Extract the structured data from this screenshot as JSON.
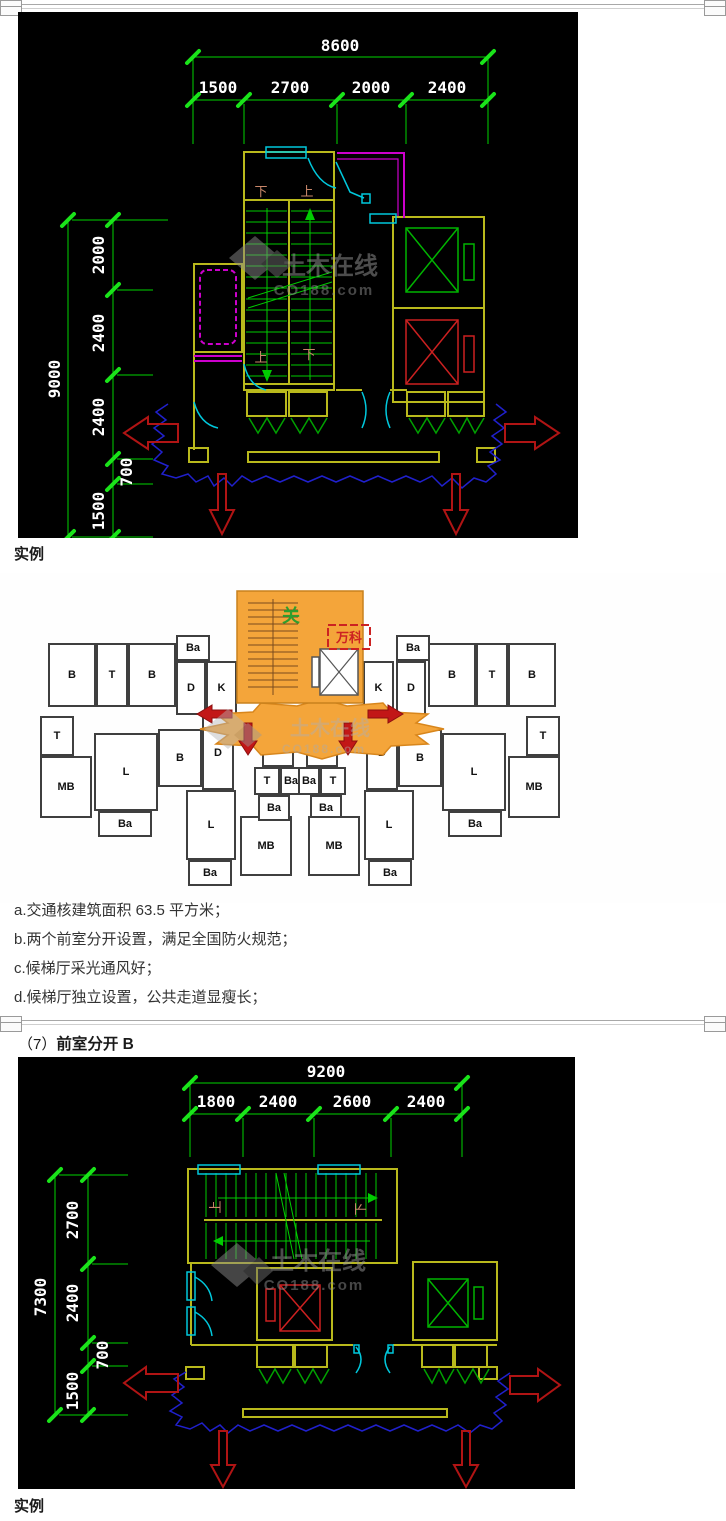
{
  "page": {
    "captions": [
      "实例",
      "实例"
    ],
    "notes": [
      "a.交通核建筑面积 63.5 平方米；",
      "b.两个前室分开设置，满足全国防火规范；",
      "c.候梯厅采光通风好；",
      "d.候梯厅独立设置，公共走道显瘦长；"
    ],
    "section_heading": {
      "index": "（7）",
      "title": "前室分开 B"
    }
  },
  "watermark": {
    "brand": "土木在线",
    "site": "CO188.com"
  },
  "cad1": {
    "top_dims": {
      "total": "8600",
      "segments": [
        "1500",
        "2700",
        "2000",
        "2400"
      ]
    },
    "left_dims": {
      "total": "9000",
      "segments": [
        "2000",
        "2400",
        "2400",
        "700",
        "1500"
      ]
    },
    "stair_labels": {
      "top_left": "下",
      "top_right": "上",
      "bottom_left": "上",
      "bottom_right": "下"
    }
  },
  "cad2": {
    "top_dims": {
      "total": "9200",
      "segments": [
        "1800",
        "2400",
        "2600",
        "2400"
      ]
    },
    "left_dims": {
      "total": "7300",
      "segments": [
        "2700",
        "2400",
        "700",
        "1500"
      ]
    },
    "stair_labels": {
      "left": "上",
      "right": "下"
    }
  },
  "plan": {
    "core_annotation": "关",
    "brand_annotation": "万科",
    "rooms": [
      {
        "label": "B",
        "x": 48,
        "y": 70,
        "w": 48,
        "h": 64
      },
      {
        "label": "T",
        "x": 96,
        "y": 70,
        "w": 32,
        "h": 64
      },
      {
        "label": "B",
        "x": 128,
        "y": 70,
        "w": 48,
        "h": 64
      },
      {
        "label": "Ba",
        "x": 176,
        "y": 62,
        "w": 34,
        "h": 26
      },
      {
        "label": "D",
        "x": 176,
        "y": 88,
        "w": 30,
        "h": 54
      },
      {
        "label": "K",
        "x": 206,
        "y": 88,
        "w": 31,
        "h": 54
      },
      {
        "label": "K",
        "x": 363,
        "y": 88,
        "w": 31,
        "h": 54
      },
      {
        "label": "Ba",
        "x": 396,
        "y": 62,
        "w": 34,
        "h": 26
      },
      {
        "label": "D",
        "x": 396,
        "y": 88,
        "w": 30,
        "h": 54
      },
      {
        "label": "B",
        "x": 428,
        "y": 70,
        "w": 48,
        "h": 64
      },
      {
        "label": "T",
        "x": 476,
        "y": 70,
        "w": 32,
        "h": 64
      },
      {
        "label": "B",
        "x": 508,
        "y": 70,
        "w": 48,
        "h": 64
      },
      {
        "label": "T",
        "x": 40,
        "y": 143,
        "w": 34,
        "h": 40
      },
      {
        "label": "MB",
        "x": 40,
        "y": 183,
        "w": 52,
        "h": 62
      },
      {
        "label": "L",
        "x": 94,
        "y": 160,
        "w": 64,
        "h": 78
      },
      {
        "label": "Ba",
        "x": 98,
        "y": 238,
        "w": 54,
        "h": 26
      },
      {
        "label": "B",
        "x": 158,
        "y": 156,
        "w": 44,
        "h": 58
      },
      {
        "label": "D",
        "x": 202,
        "y": 143,
        "w": 32,
        "h": 74
      },
      {
        "label": "L",
        "x": 186,
        "y": 217,
        "w": 50,
        "h": 70
      },
      {
        "label": "Ba",
        "x": 188,
        "y": 287,
        "w": 44,
        "h": 26
      },
      {
        "label": "MB",
        "x": 240,
        "y": 243,
        "w": 52,
        "h": 60
      },
      {
        "label": "K",
        "x": 262,
        "y": 156,
        "w": 32,
        "h": 38
      },
      {
        "label": "T",
        "x": 254,
        "y": 194,
        "w": 26,
        "h": 28
      },
      {
        "label": "Ba",
        "x": 280,
        "y": 194,
        "w": 22,
        "h": 28
      },
      {
        "label": "Ba",
        "x": 258,
        "y": 222,
        "w": 32,
        "h": 26
      },
      {
        "label": "K",
        "x": 306,
        "y": 156,
        "w": 32,
        "h": 38
      },
      {
        "label": "Ba",
        "x": 298,
        "y": 194,
        "w": 22,
        "h": 28
      },
      {
        "label": "T",
        "x": 320,
        "y": 194,
        "w": 26,
        "h": 28
      },
      {
        "label": "Ba",
        "x": 310,
        "y": 222,
        "w": 32,
        "h": 26
      },
      {
        "label": "MB",
        "x": 308,
        "y": 243,
        "w": 52,
        "h": 60
      },
      {
        "label": "L",
        "x": 364,
        "y": 217,
        "w": 50,
        "h": 70
      },
      {
        "label": "Ba",
        "x": 368,
        "y": 287,
        "w": 44,
        "h": 26
      },
      {
        "label": "D",
        "x": 366,
        "y": 143,
        "w": 32,
        "h": 74
      },
      {
        "label": "B",
        "x": 398,
        "y": 156,
        "w": 44,
        "h": 58
      },
      {
        "label": "L",
        "x": 442,
        "y": 160,
        "w": 64,
        "h": 78
      },
      {
        "label": "Ba",
        "x": 448,
        "y": 238,
        "w": 54,
        "h": 26
      },
      {
        "label": "T",
        "x": 526,
        "y": 143,
        "w": 34,
        "h": 40
      },
      {
        "label": "MB",
        "x": 508,
        "y": 183,
        "w": 52,
        "h": 62
      }
    ]
  },
  "colors": {
    "cad_background": "#000000",
    "dimension_green": "#00d400",
    "wall_yellow": "#b9b91c",
    "cyan": "#00c8dc",
    "magenta": "#cc00cc",
    "elevator_red": "#cc2020",
    "elevator_green": "#00b400",
    "arrow_red": "#b01414",
    "route_blue": "#2020cc",
    "core_orange": "#f4a53a",
    "watermark_gray": "#9a9a9a"
  }
}
